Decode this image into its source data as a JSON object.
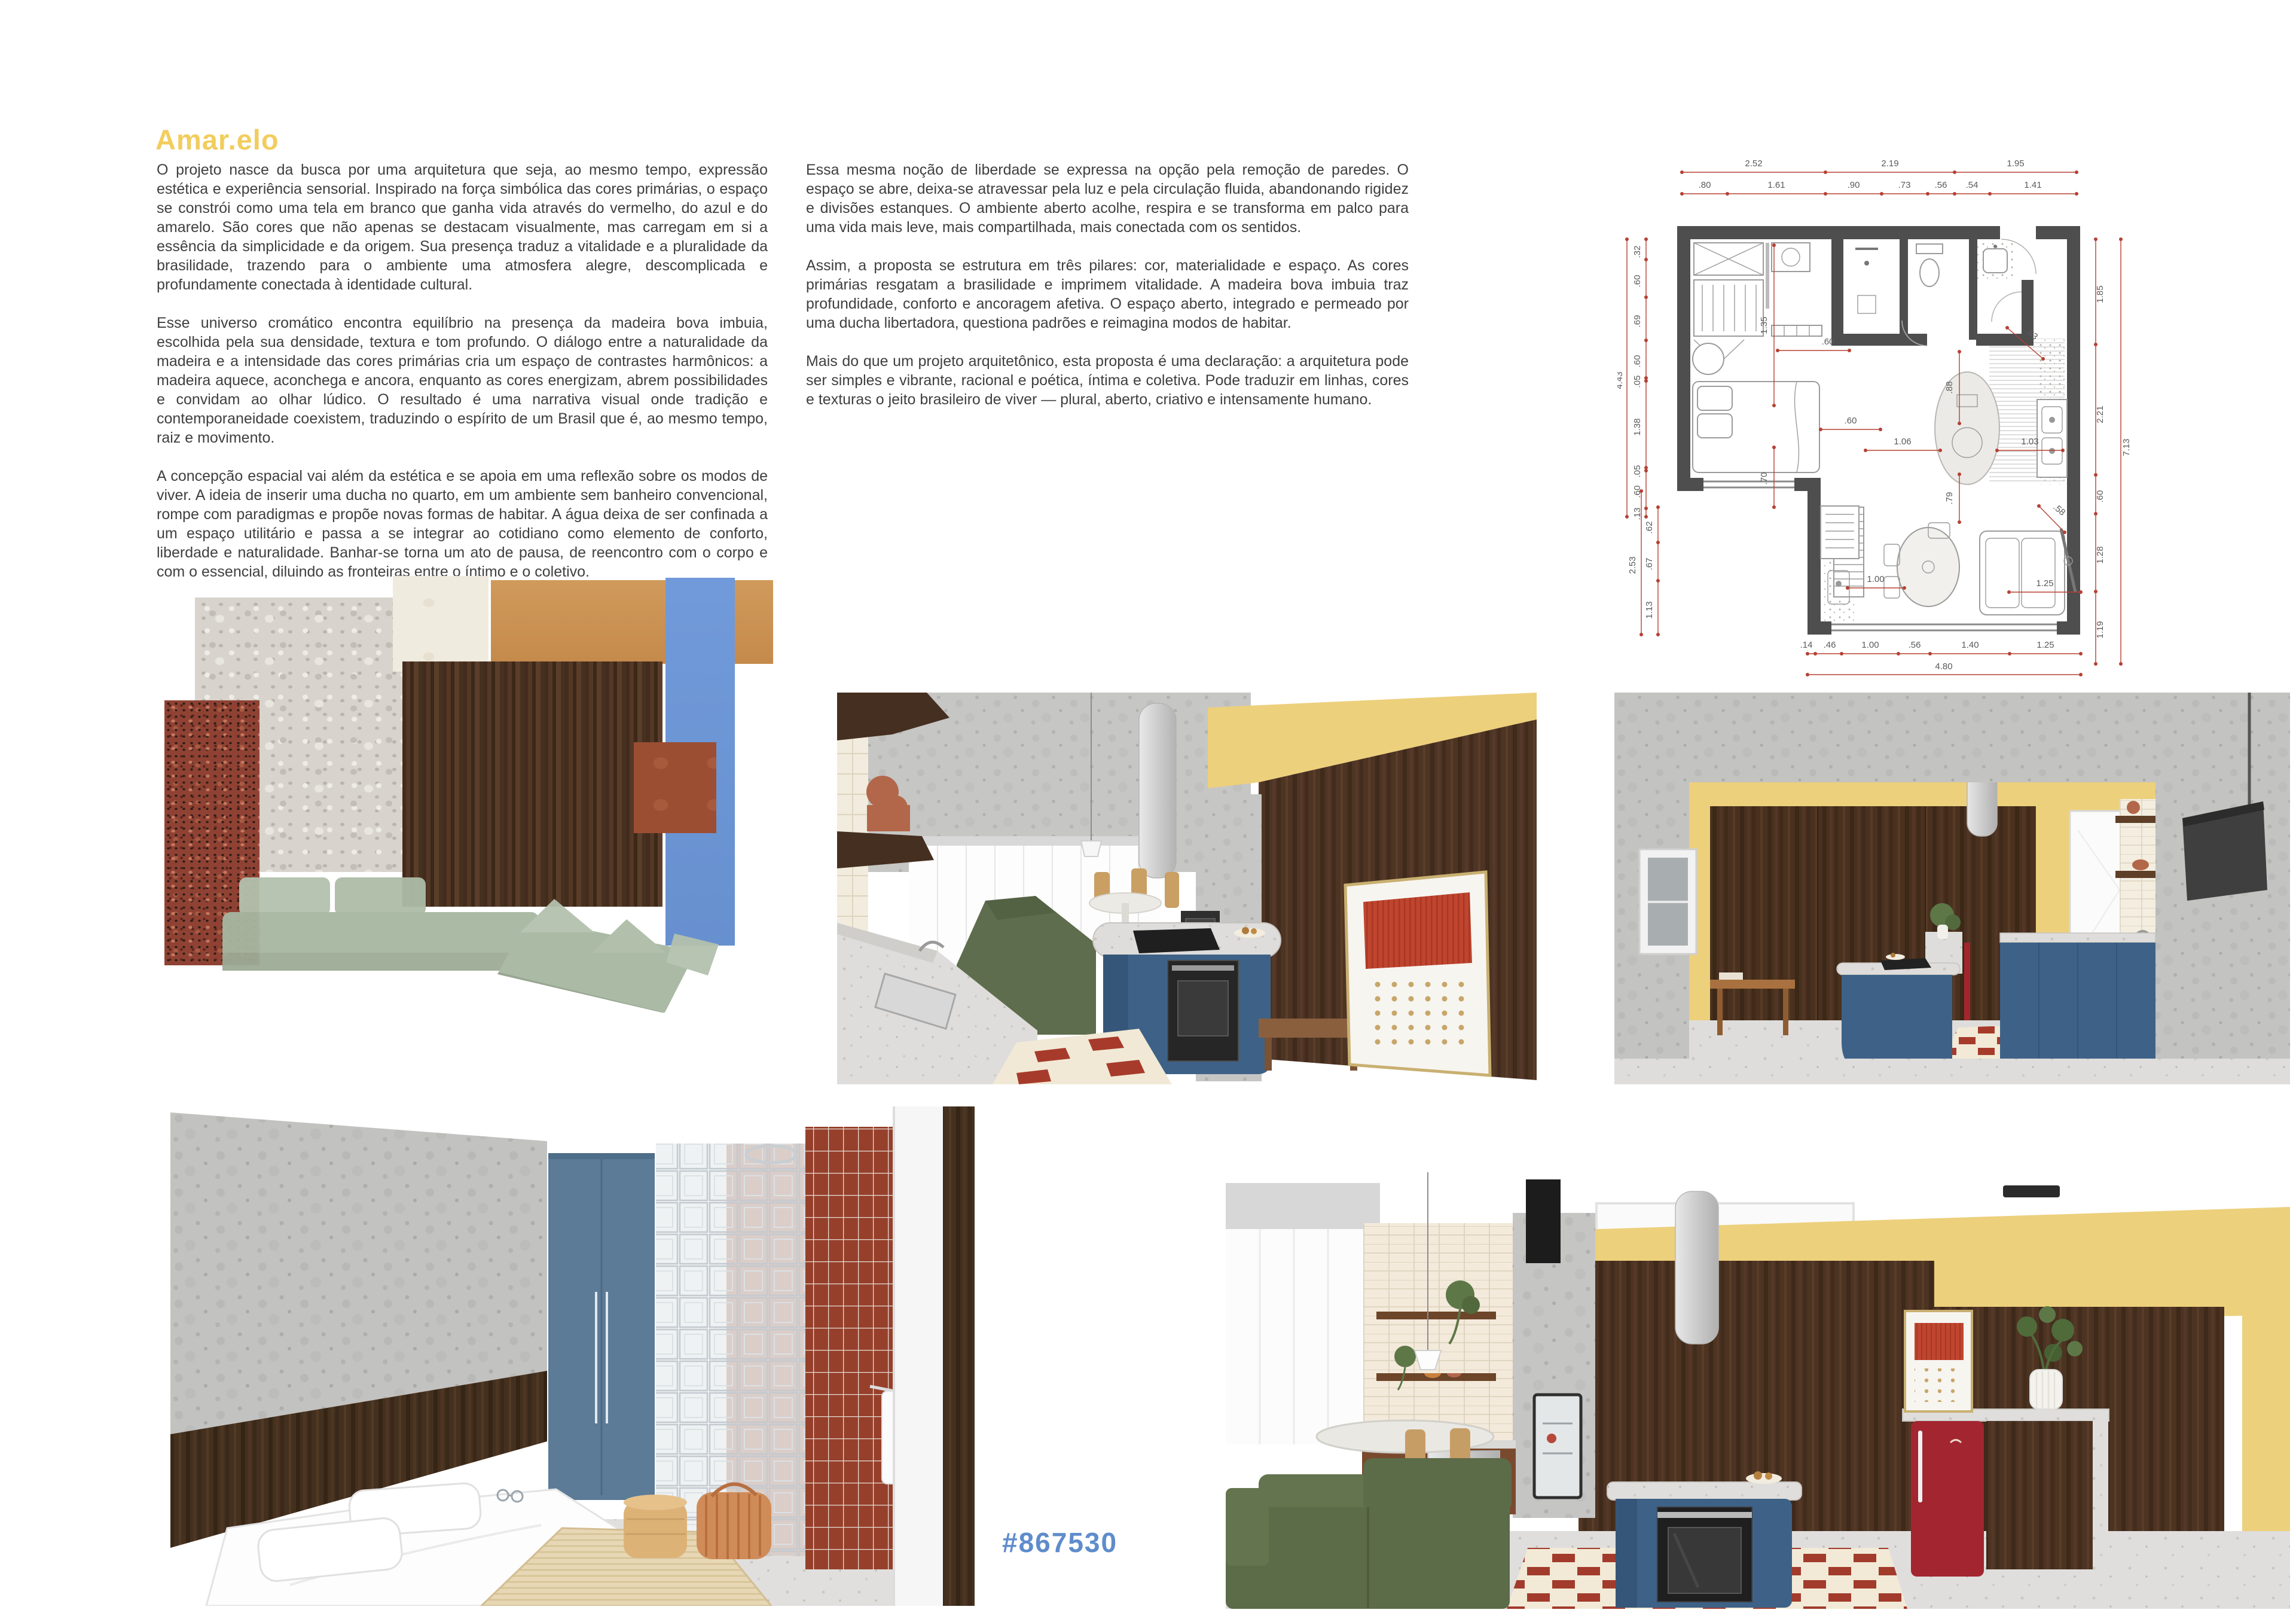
{
  "header": {
    "title": "Amar.elo"
  },
  "footer": {
    "hashtag": "#867530"
  },
  "intro": {
    "left_paragraphs": [
      "O projeto nasce da busca por uma arquitetura que seja, ao mesmo tempo, expressão estética e experiência sensorial. Inspirado na força simbólica das cores primárias, o espaço se constrói como uma tela em branco que ganha vida através do vermelho, do azul e do amarelo. São cores que não apenas se destacam visualmente, mas carregam em si a essência da simplicidade e da origem. Sua presença traduz a vitalidade e a pluralidade da brasilidade, trazendo para o ambiente uma atmosfera alegre, descomplicada e profundamente conectada à identidade cultural.",
      "Esse universo cromático encontra equilíbrio na presença da madeira bova imbuia, escolhida pela sua densidade, textura e tom profundo. O diálogo entre a naturalidade da madeira e a intensidade das cores primárias cria um espaço de contrastes harmônicos: a madeira aquece, aconchega e ancora, enquanto as cores energizam, abrem possibilidades e convidam ao olhar lúdico. O resultado é uma narrativa visual onde tradição e contemporaneidade coexistem, traduzindo o espírito de um Brasil que é, ao mesmo tempo, raiz e movimento.",
      "A concepção espacial vai além da estética e se apoia em uma reflexão sobre os modos de viver. A ideia de inserir uma ducha no quarto, em um ambiente sem banheiro convencional, rompe com paradigmas e propõe novas formas de habitar. A água deixa de ser confinada a um espaço utilitário e passa a se integrar ao cotidiano como elemento de conforto, liberdade e naturalidade. Banhar-se torna um ato de pausa, de reencontro com o corpo e com o essencial, diluindo as fronteiras entre o íntimo e o coletivo."
    ],
    "right_paragraphs": [
      "Essa mesma noção de liberdade se expressa na opção pela remoção de paredes. O espaço se abre, deixa-se atravessar pela luz e pela circulação fluida, abandonando rigidez e divisões estanques. O ambiente aberto acolhe, respira e se transforma em palco para uma vida mais leve, mais compartilhada, mais conectada com os sentidos.",
      "Assim, a proposta se estrutura em três pilares: cor, materialidade e espaço. As cores primárias resgatam a brasilidade e imprimem vitalidade. A madeira bova imbuia traz profundidade, conforto e ancoragem afetiva. O espaço aberto, integrado e permeado por uma ducha libertadora, questiona padrões e reimagina modos de habitar.",
      "Mais do que um projeto arquitetônico, esta proposta é uma declaração: a arquitetura pode ser simples e vibrante, racional e poética, íntima e coletiva. Pode traduzir em linhas, cores e texturas o jeito brasileiro de viver — plural, aberto, criativo e intensamente humano."
    ]
  },
  "floor_plan": {
    "top_primary": [
      "2.52",
      "2.19",
      "1.95"
    ],
    "top_secondary": [
      ".80",
      "1.61",
      ".90",
      ".73",
      ".56",
      ".54",
      "1.41"
    ],
    "left_upper": [
      ".32",
      ".60",
      ".69",
      ".60",
      ".05",
      "1.38",
      ".05",
      ".60",
      ".13"
    ],
    "left_upper_total": "4.43",
    "left_lower": [
      ".62",
      ".67",
      "1.13"
    ],
    "left_lower_total": "2.53",
    "right_side": [
      "1.85",
      "2.21",
      ".60",
      "1.28",
      "1.19"
    ],
    "right_total": "7.13",
    "bottom": [
      ".14",
      ".46",
      "1.00",
      ".56",
      "1.40",
      "1.25"
    ],
    "bottom_total": "4.80",
    "interior": [
      "1.35",
      ".60",
      ".60",
      ".70",
      "1.06",
      "1.03",
      ".88",
      ".83",
      ".79",
      ".58",
      "1.00",
      "1.25"
    ]
  },
  "palette": {
    "title_yellow": "#F2CD5D",
    "hashtag_blue": "#5F8CCB",
    "wall_yellow": "#EDD07C",
    "granite_red": "#8F4233",
    "terrazzo_gray": "#D8D4CD",
    "tile_offwhite": "#F0EBDF",
    "leather_caramel": "#C99152",
    "wood_imbuia": "#4D3423",
    "primary_blue": "#6C95D6",
    "terracotta": "#9C4E33",
    "sofa_sage": "#AEBDAA",
    "sofa_olive": "#5C6B48",
    "island_blue": "#3E6287",
    "fridge_red": "#A32530",
    "dimension_red": "#B54034"
  }
}
